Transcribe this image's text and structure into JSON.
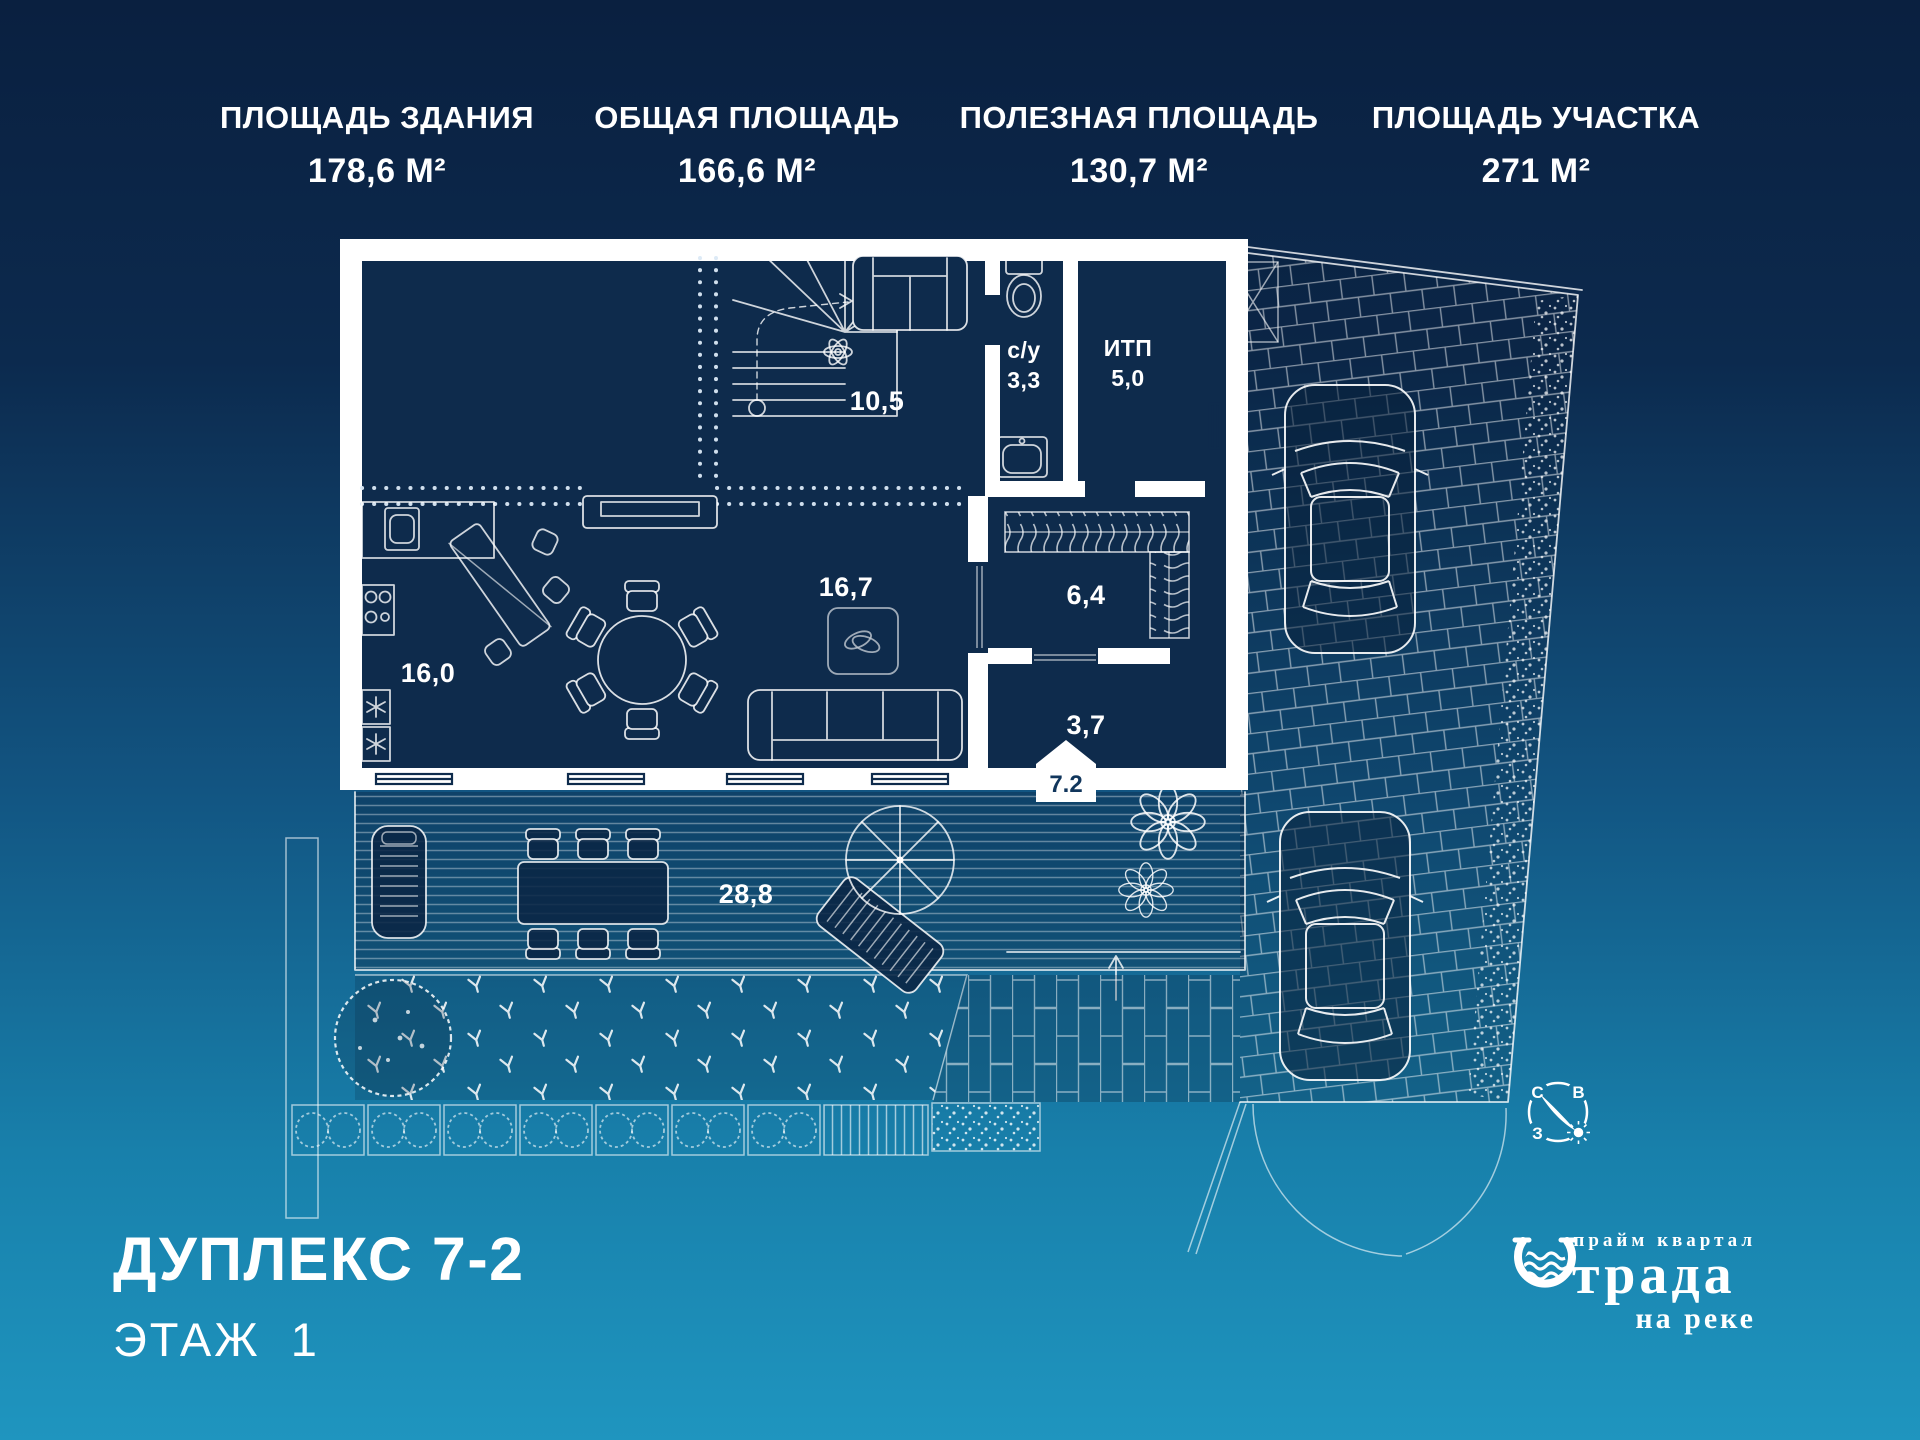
{
  "stats": [
    {
      "label": "ПЛОЩАДЬ ЗДАНИЯ",
      "value": "178,6 М²"
    },
    {
      "label": "ОБЩАЯ ПЛОЩАДЬ",
      "value": "166,6 М²"
    },
    {
      "label": "ПОЛЕЗНАЯ ПЛОЩАДЬ",
      "value": "130,7 М²"
    },
    {
      "label": "ПЛОЩАДЬ УЧАСТКА",
      "value": "271 М²"
    }
  ],
  "plan": {
    "rooms": {
      "hall_upper": "10,5",
      "bathroom_name": "с/у",
      "bathroom_area": "3,3",
      "itp_name": "ИТП",
      "itp_area": "5,0",
      "living": "16,7",
      "hallway": "6,4",
      "kitchen": "16,0",
      "entry": "3,7",
      "terrace": "28,8"
    },
    "porch_badge": "7.2",
    "compass": {
      "n": "С",
      "e": "В",
      "w": "З"
    }
  },
  "footer": {
    "title": "ДУПЛЕКС 7-2",
    "floor": "ЭТАЖ 1"
  },
  "logo": {
    "top": "прайм квартал",
    "main": "трада",
    "sub": "на реке"
  },
  "colors": {
    "bg_top": "#0a2040",
    "bg_bottom": "#1f95bf",
    "interior": "#0e2b4c",
    "line": "#ffffff"
  }
}
